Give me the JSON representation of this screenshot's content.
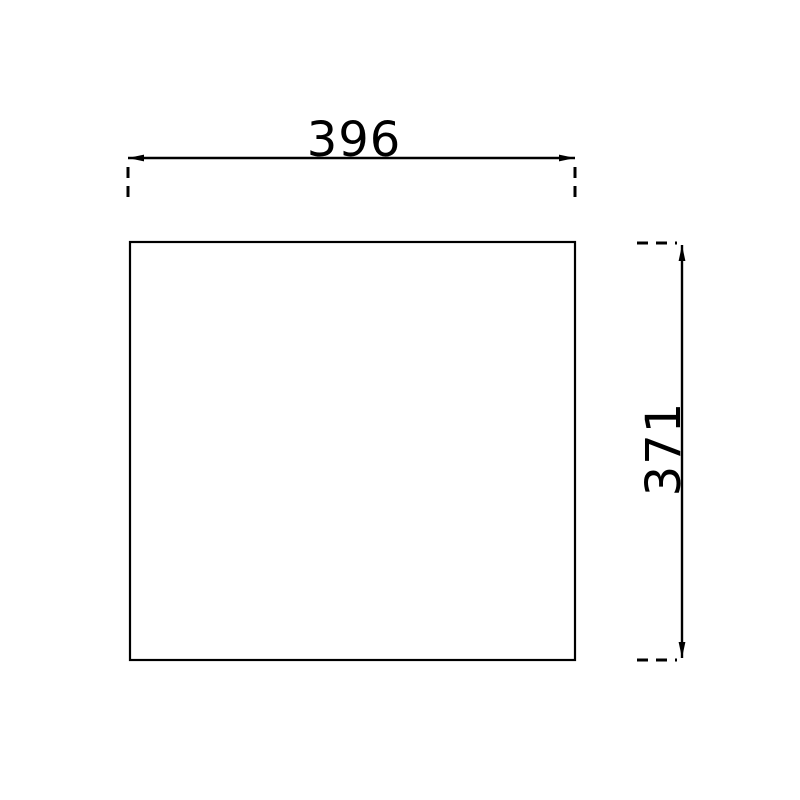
{
  "drawing": {
    "type": "technical-dimension-drawing",
    "background_color": "#ffffff",
    "line_color": "#000000",
    "shape": "rectangle",
    "dimensions": {
      "width": {
        "label": "396",
        "value": 396,
        "orientation": "horizontal"
      },
      "height": {
        "label": "371",
        "value": 371,
        "orientation": "vertical"
      }
    }
  }
}
